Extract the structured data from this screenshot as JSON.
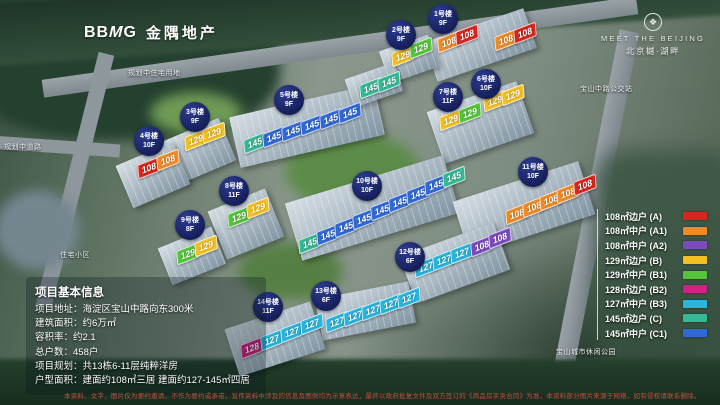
{
  "header": {
    "brand_left": {
      "logo_bb": "BB",
      "logo_m": "M",
      "logo_g": "G",
      "name": "金隅地产"
    },
    "brand_right": {
      "emblem_glyph": "❖",
      "tagline": "MEET THE BEIJING",
      "name": "北京樾·湖畔"
    }
  },
  "colors": {
    "a": "#d7261d",
    "a1": "#ef8b27",
    "a2": "#7b4bbd",
    "b": "#f2c021",
    "b1": "#55c43b",
    "b2": "#d61f82",
    "b3": "#2ab5dd",
    "c": "#35b894",
    "c1": "#3069d6"
  },
  "legend": {
    "items": [
      {
        "label": "108㎡边户 (A)",
        "color_key": "a",
        "color": "#d7261d"
      },
      {
        "label": "108㎡中户 (A1)",
        "color_key": "a1",
        "color": "#ef8b27"
      },
      {
        "label": "108㎡中户 (A2)",
        "color_key": "a2",
        "color": "#7b4bbd"
      },
      {
        "label": "129㎡边户 (B)",
        "color_key": "b",
        "color": "#f2c021"
      },
      {
        "label": "129㎡中户 (B1)",
        "color_key": "b1",
        "color": "#55c43b"
      },
      {
        "label": "128㎡边户 (B2)",
        "color_key": "b2",
        "color": "#d61f82"
      },
      {
        "label": "127㎡中户 (B3)",
        "color_key": "b3",
        "color": "#2ab5dd"
      },
      {
        "label": "145㎡边户 (C)",
        "color_key": "c",
        "color": "#35b894"
      },
      {
        "label": "145㎡中户 (C1)",
        "color_key": "c1",
        "color": "#3069d6"
      }
    ]
  },
  "info_panel": {
    "title": "项目基本信息",
    "lines": [
      "项目地址：海淀区宝山中路向东300米",
      "建筑面积：约6万㎡",
      "容积率：约2.1",
      "总户数：458户",
      "项目规划：共13栋6-11层纯粹洋房",
      "户型面积：建面约108㎡三居  建面约127-145㎡四居"
    ]
  },
  "map_labels": [
    {
      "text": "规划中住宅用地",
      "x": 128,
      "y": 68
    },
    {
      "text": "规划中道路",
      "x": 4,
      "y": 142
    },
    {
      "text": "住宅小区",
      "x": 60,
      "y": 250
    },
    {
      "text": "宝山中路公交站",
      "x": 580,
      "y": 84
    },
    {
      "text": "宝山城市休闲公园",
      "x": 556,
      "y": 347
    }
  ],
  "buildings": [
    {
      "name": "1号楼",
      "floors": "9F",
      "badge": {
        "x": 428,
        "y": 4
      },
      "tags": [
        {
          "t": "108",
          "c": "a1",
          "x": 437,
          "y": 35
        },
        {
          "t": "108",
          "c": "a",
          "x": 455,
          "y": 28
        },
        {
          "t": "108",
          "c": "a1",
          "x": 494,
          "y": 33
        },
        {
          "t": "108",
          "c": "a",
          "x": 513,
          "y": 26
        }
      ]
    },
    {
      "name": "2号楼",
      "floors": "9F",
      "badge": {
        "x": 386,
        "y": 20
      },
      "tags": [
        {
          "t": "129",
          "c": "b",
          "x": 391,
          "y": 49
        },
        {
          "t": "129",
          "c": "b1",
          "x": 409,
          "y": 41
        }
      ]
    },
    {
      "name": "3号楼",
      "floors": "9F",
      "badge": {
        "x": 180,
        "y": 102
      },
      "tags": [
        {
          "t": "129",
          "c": "b",
          "x": 184,
          "y": 133
        },
        {
          "t": "129",
          "c": "b",
          "x": 202,
          "y": 126
        }
      ]
    },
    {
      "name": "4号楼",
      "floors": "10F",
      "badge": {
        "x": 134,
        "y": 126
      },
      "tags": [
        {
          "t": "108",
          "c": "a",
          "x": 137,
          "y": 161
        },
        {
          "t": "108",
          "c": "a1",
          "x": 156,
          "y": 153
        }
      ]
    },
    {
      "name": "5号楼",
      "floors": "9F",
      "badge": {
        "x": 274,
        "y": 85
      },
      "tags": [
        {
          "t": "145",
          "c": "c",
          "x": 243,
          "y": 136
        },
        {
          "t": "145",
          "c": "c1",
          "x": 262,
          "y": 130
        },
        {
          "t": "145",
          "c": "c1",
          "x": 281,
          "y": 124
        },
        {
          "t": "145",
          "c": "c1",
          "x": 300,
          "y": 118
        },
        {
          "t": "145",
          "c": "c1",
          "x": 319,
          "y": 112
        },
        {
          "t": "145",
          "c": "c1",
          "x": 338,
          "y": 106
        },
        {
          "t": "145",
          "c": "c",
          "x": 359,
          "y": 81
        },
        {
          "t": "145",
          "c": "c",
          "x": 377,
          "y": 75
        }
      ]
    },
    {
      "name": "6号楼",
      "floors": "10F",
      "badge": {
        "x": 471,
        "y": 69
      },
      "tags": [
        {
          "t": "129",
          "c": "b",
          "x": 483,
          "y": 94
        },
        {
          "t": "129",
          "c": "b",
          "x": 501,
          "y": 88
        }
      ]
    },
    {
      "name": "7号楼",
      "floors": "11F",
      "badge": {
        "x": 433,
        "y": 82
      },
      "tags": [
        {
          "t": "129",
          "c": "b",
          "x": 439,
          "y": 113
        },
        {
          "t": "129",
          "c": "b1",
          "x": 458,
          "y": 106
        }
      ]
    },
    {
      "name": "8号楼",
      "floors": "11F",
      "badge": {
        "x": 219,
        "y": 176
      },
      "tags": [
        {
          "t": "129",
          "c": "b1",
          "x": 227,
          "y": 210
        },
        {
          "t": "129",
          "c": "b",
          "x": 246,
          "y": 201
        }
      ]
    },
    {
      "name": "9号楼",
      "floors": "8F",
      "badge": {
        "x": 175,
        "y": 210
      },
      "tags": [
        {
          "t": "129",
          "c": "b1",
          "x": 176,
          "y": 247
        },
        {
          "t": "129",
          "c": "b",
          "x": 194,
          "y": 239
        }
      ]
    },
    {
      "name": "10号楼",
      "floors": "10F",
      "badge": {
        "x": 352,
        "y": 171
      },
      "tags": [
        {
          "t": "145",
          "c": "c",
          "x": 298,
          "y": 236
        },
        {
          "t": "145",
          "c": "c1",
          "x": 316,
          "y": 228
        },
        {
          "t": "145",
          "c": "c1",
          "x": 334,
          "y": 220
        },
        {
          "t": "145",
          "c": "c1",
          "x": 352,
          "y": 212
        },
        {
          "t": "145",
          "c": "c1",
          "x": 370,
          "y": 203
        },
        {
          "t": "145",
          "c": "c1",
          "x": 388,
          "y": 195
        },
        {
          "t": "145",
          "c": "c1",
          "x": 406,
          "y": 187
        },
        {
          "t": "145",
          "c": "c1",
          "x": 424,
          "y": 178
        },
        {
          "t": "145",
          "c": "c",
          "x": 442,
          "y": 170
        }
      ]
    },
    {
      "name": "11号楼",
      "floors": "10F",
      "badge": {
        "x": 518,
        "y": 157
      },
      "tags": [
        {
          "t": "108",
          "c": "a1",
          "x": 505,
          "y": 207
        },
        {
          "t": "108",
          "c": "a1",
          "x": 522,
          "y": 200
        },
        {
          "t": "108",
          "c": "a1",
          "x": 539,
          "y": 193
        },
        {
          "t": "108",
          "c": "a1",
          "x": 556,
          "y": 186
        },
        {
          "t": "108",
          "c": "a",
          "x": 573,
          "y": 178
        }
      ]
    },
    {
      "name": "12号楼",
      "floors": "6F",
      "badge": {
        "x": 395,
        "y": 242
      },
      "tags": [
        {
          "t": "127",
          "c": "b3",
          "x": 414,
          "y": 260
        },
        {
          "t": "127",
          "c": "b3",
          "x": 432,
          "y": 253
        },
        {
          "t": "127",
          "c": "b3",
          "x": 450,
          "y": 246
        },
        {
          "t": "108",
          "c": "a2",
          "x": 470,
          "y": 239
        },
        {
          "t": "108",
          "c": "a2",
          "x": 488,
          "y": 231
        }
      ]
    },
    {
      "name": "13号楼",
      "floors": "6F",
      "badge": {
        "x": 311,
        "y": 281
      },
      "tags": [
        {
          "t": "127",
          "c": "b3",
          "x": 325,
          "y": 315
        },
        {
          "t": "127",
          "c": "b3",
          "x": 343,
          "y": 309
        },
        {
          "t": "127",
          "c": "b3",
          "x": 361,
          "y": 303
        },
        {
          "t": "127",
          "c": "b3",
          "x": 379,
          "y": 297
        },
        {
          "t": "127",
          "c": "b3",
          "x": 397,
          "y": 291
        }
      ]
    },
    {
      "name": "14号楼",
      "floors": "11F",
      "badge": {
        "x": 253,
        "y": 292
      },
      "tags": [
        {
          "t": "128",
          "c": "b2",
          "x": 240,
          "y": 341
        },
        {
          "t": "127",
          "c": "b3",
          "x": 260,
          "y": 333
        },
        {
          "t": "127",
          "c": "b3",
          "x": 280,
          "y": 325
        },
        {
          "t": "127",
          "c": "b3",
          "x": 300,
          "y": 317
        }
      ]
    }
  ],
  "disclaimer": "本资料、文字、图片仅为要约邀请，不作为要约或承诺，宣传资料中涉及的信息及图例均为示意表达，最终以政府批复文件及双方签订的《商品房买卖合同》为准，本资料部分图片来源于网络，如有侵权请联系删除。"
}
